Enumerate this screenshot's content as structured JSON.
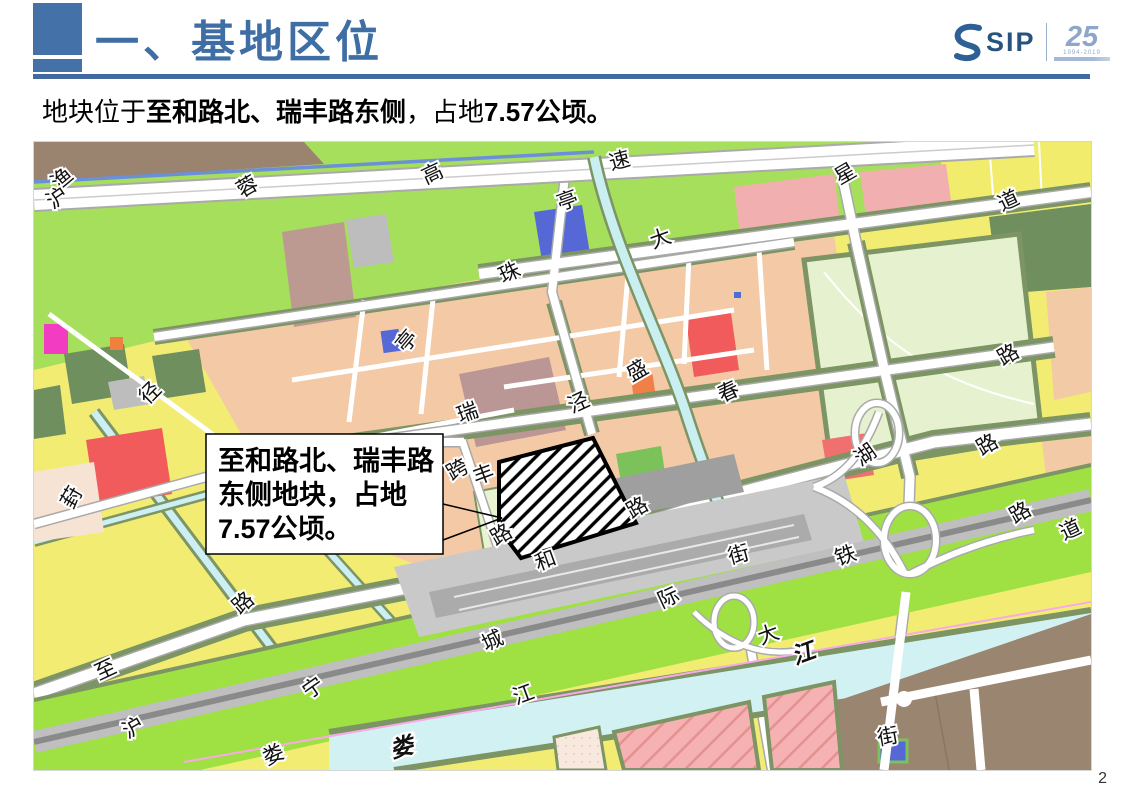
{
  "header": {
    "title": "一、基地区位",
    "logo": {
      "brand": "SIP",
      "anniversary": "25",
      "caption": "1994-2019"
    }
  },
  "subtitle": {
    "segments": [
      {
        "text": "地块位于",
        "bold": false
      },
      {
        "text": "至和路北、瑞丰路东侧",
        "bold": true
      },
      {
        "text": "，占地",
        "bold": false
      },
      {
        "text": "7.57公顷。",
        "bold": true
      }
    ]
  },
  "map": {
    "callout": {
      "lines": [
        "至和路北、瑞丰路",
        "东侧地块，占地",
        "7.57公顷。"
      ]
    },
    "labels": [
      {
        "t": "渔",
        "x": 29,
        "y": 38,
        "r": -40
      },
      {
        "t": "沪",
        "x": 24,
        "y": 57,
        "r": -35
      },
      {
        "t": "蓉",
        "x": 214,
        "y": 46,
        "r": -30
      },
      {
        "t": "高",
        "x": 399,
        "y": 33,
        "r": -25
      },
      {
        "t": "速",
        "x": 586,
        "y": 20,
        "r": -15
      },
      {
        "t": "亭",
        "x": 534,
        "y": 60,
        "r": -20
      },
      {
        "t": "星",
        "x": 812,
        "y": 33,
        "r": -30
      },
      {
        "t": "道",
        "x": 975,
        "y": 60,
        "r": -25
      },
      {
        "t": "大",
        "x": 627,
        "y": 98,
        "r": -20
      },
      {
        "t": "珠",
        "x": 476,
        "y": 132,
        "r": -25
      },
      {
        "t": "亭",
        "x": 374,
        "y": 200,
        "r": -50
      },
      {
        "t": "路",
        "x": 975,
        "y": 214,
        "r": -30
      },
      {
        "t": "径",
        "x": 117,
        "y": 252,
        "r": -45
      },
      {
        "t": "葑",
        "x": 39,
        "y": 356,
        "r": -60
      },
      {
        "t": "瑞",
        "x": 434,
        "y": 272,
        "r": -20
      },
      {
        "t": "泾",
        "x": 545,
        "y": 262,
        "r": -25
      },
      {
        "t": "盛",
        "x": 604,
        "y": 230,
        "r": -30
      },
      {
        "t": "春",
        "x": 695,
        "y": 251,
        "r": -25
      },
      {
        "t": "湖",
        "x": 832,
        "y": 314,
        "r": -35
      },
      {
        "t": "路",
        "x": 954,
        "y": 304,
        "r": -30
      },
      {
        "t": "跨",
        "x": 424,
        "y": 329,
        "r": -30
      },
      {
        "t": "丰",
        "x": 450,
        "y": 334,
        "r": -20
      },
      {
        "t": "路",
        "x": 468,
        "y": 394,
        "r": -30
      },
      {
        "t": "和",
        "x": 512,
        "y": 420,
        "r": -20
      },
      {
        "t": "路",
        "x": 604,
        "y": 367,
        "r": -30
      },
      {
        "t": "街",
        "x": 705,
        "y": 414,
        "r": -15
      },
      {
        "t": "铁",
        "x": 812,
        "y": 415,
        "r": -20
      },
      {
        "t": "路",
        "x": 987,
        "y": 372,
        "r": -30
      },
      {
        "t": "道",
        "x": 1037,
        "y": 389,
        "r": -25
      },
      {
        "t": "路",
        "x": 210,
        "y": 462,
        "r": -40
      },
      {
        "t": "际",
        "x": 635,
        "y": 457,
        "r": -25
      },
      {
        "t": "城",
        "x": 459,
        "y": 500,
        "r": -25
      },
      {
        "t": "大",
        "x": 735,
        "y": 494,
        "r": -20
      },
      {
        "t": "江",
        "x": 490,
        "y": 554,
        "r": -20
      },
      {
        "t": "至",
        "x": 72,
        "y": 529,
        "r": -25
      },
      {
        "t": "宁",
        "x": 280,
        "y": 547,
        "r": -35
      },
      {
        "t": "沪",
        "x": 100,
        "y": 587,
        "r": -30
      },
      {
        "t": "娄",
        "x": 240,
        "y": 614,
        "r": -25
      },
      {
        "t": "娄",
        "x": 368,
        "y": 607,
        "r": -15,
        "c": "#1C57B8",
        "b": true
      },
      {
        "t": "江",
        "x": 770,
        "y": 513,
        "r": -20,
        "c": "#1C57B8",
        "b": true
      },
      {
        "t": "街",
        "x": 854,
        "y": 596,
        "r": -10
      }
    ],
    "colors": {
      "farmland_yellow": "#F2ED72",
      "greenland": "#A6DF5C",
      "residential_salmon": "#F4C9A5",
      "verge_olive": "#7D9464",
      "water_cyan": "#D2F1F3",
      "river_blue_line": "#6C8FD8",
      "rail_green": "#9FE042",
      "station_gray": "#C9C9C9",
      "urban_brown": "#9A8571",
      "pink_block": "#F6B2B2",
      "label_blue": "#1C57B8",
      "accent_blue": "#4472A8"
    }
  },
  "page": {
    "number": "2"
  }
}
